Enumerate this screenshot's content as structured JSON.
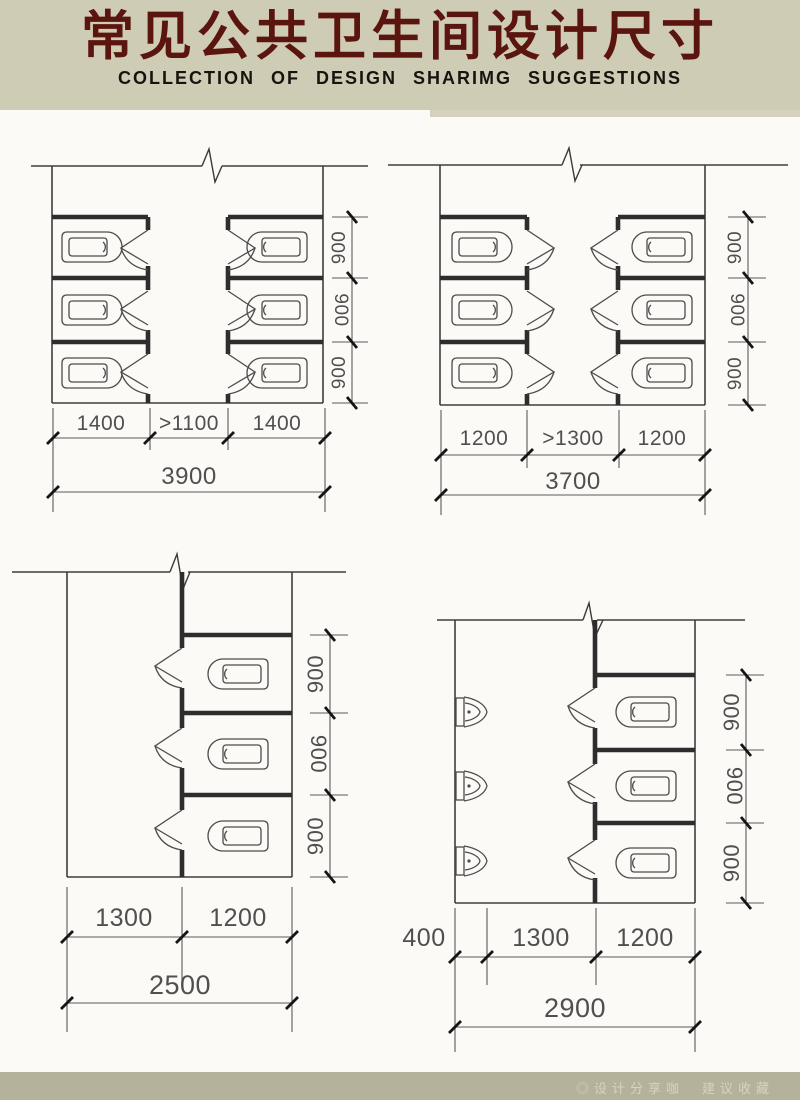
{
  "header": {
    "title": "常见公共卫生间设计尺寸",
    "subtitle": "COLLECTION OF DESIGN SHARIMG SUGGESTIONS",
    "bg_color": "#cfccb6",
    "title_color": "#5a150e",
    "subtitle_color": "#17130f"
  },
  "footer": {
    "watermark": "◎设计分享咖　建议收藏",
    "bg_color": "#b5b29c",
    "text_color": "#dcd9c4"
  },
  "icons": {
    "toilet": "squat-toilet-icon",
    "door": "door-swing-icon",
    "urinal": "urinal-icon",
    "break": "wall-break-icon",
    "tick": "dimension-tick"
  },
  "drawing": {
    "line_color": "#3e3e3e",
    "dim_text_color": "#4f4f4f",
    "canvas_color": "#fbfaf6"
  },
  "diagrams": [
    {
      "name": "double-row-facing-1400",
      "depth_labels": [
        "900",
        "900",
        "900"
      ],
      "width_segments": [
        "1400",
        ">1100",
        "1400"
      ],
      "total_width": "3900"
    },
    {
      "name": "double-row-facing-1200",
      "depth_labels": [
        "900",
        "900",
        "900"
      ],
      "width_segments": [
        "1200",
        ">1300",
        "1200"
      ],
      "total_width": "3700"
    },
    {
      "name": "single-row-1200",
      "depth_labels": [
        "900",
        "900",
        "900"
      ],
      "width_segments": [
        "1300",
        "1200"
      ],
      "total_width": "2500"
    },
    {
      "name": "single-row-with-urinals",
      "depth_labels": [
        "900",
        "900",
        "900"
      ],
      "width_segments": [
        "400",
        "1300",
        "1200"
      ],
      "total_width": "2900"
    }
  ]
}
